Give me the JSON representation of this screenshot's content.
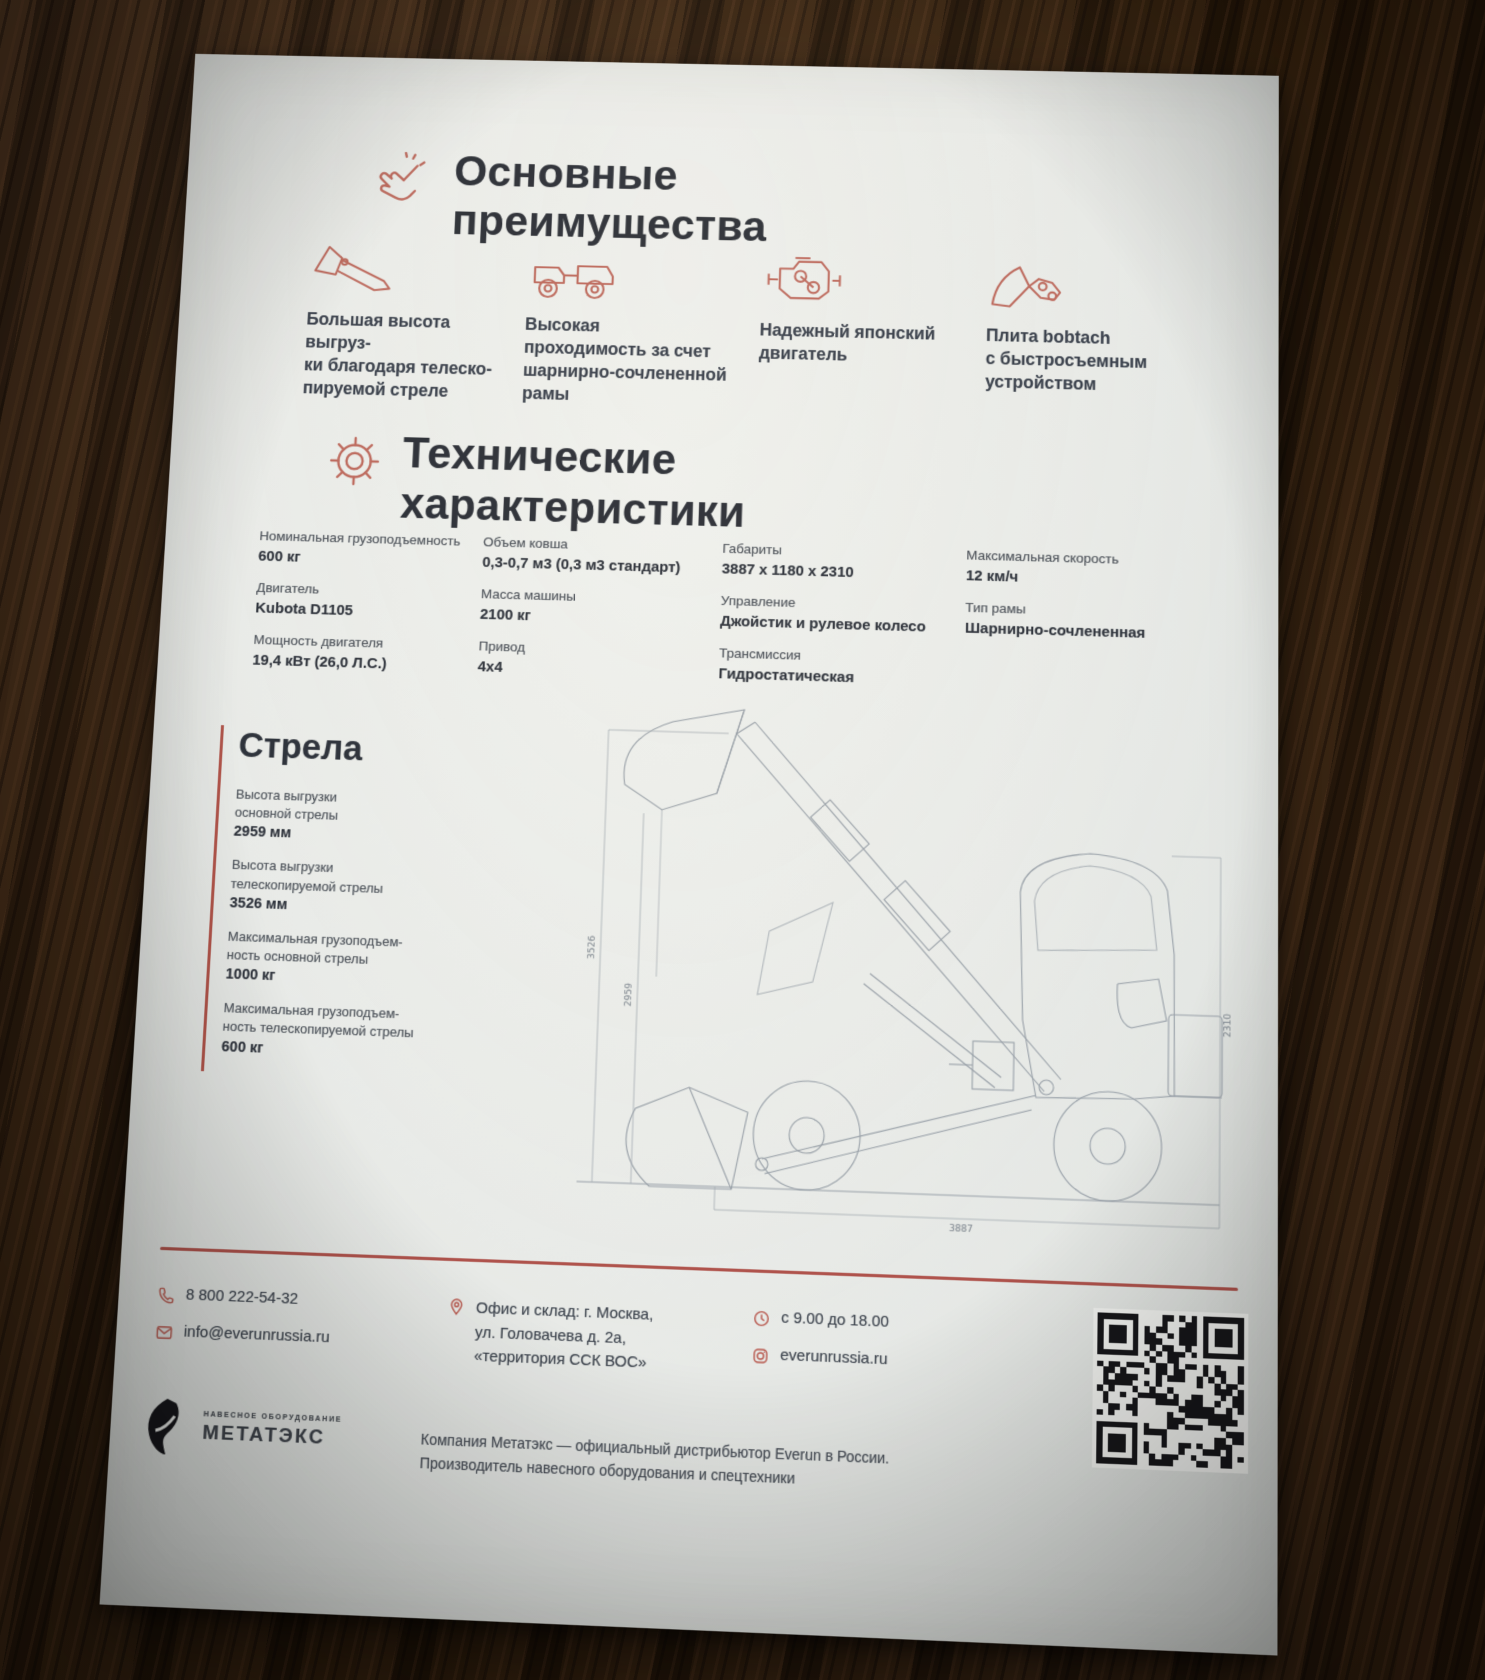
{
  "colors": {
    "accent_icon": "#bd6a5e",
    "accent_line": "#a8433b",
    "heading_ink": "#2b2f37",
    "body_ink": "#3a414d",
    "paper": "#e9ebe8"
  },
  "advantages_section": {
    "title_line1": "Основные",
    "title_line2": "преимущества",
    "items": [
      {
        "icon": "bucket-boom-icon",
        "lines": [
          "Большая высота выгруз-",
          "ки благодаря телеско-",
          "пируемой стреле"
        ]
      },
      {
        "icon": "articulated-loader-icon",
        "lines": [
          "Высокая",
          "проходимость за счет",
          "шарнирно-сочлененной",
          "рамы"
        ]
      },
      {
        "icon": "engine-icon",
        "lines": [
          "Надежный японский",
          "двигатель",
          "",
          ""
        ]
      },
      {
        "icon": "bobtach-plate-icon",
        "lines": [
          "Плита bobtach",
          "с быстросъемным",
          "устройством",
          ""
        ]
      }
    ]
  },
  "specs_section": {
    "title_line1": "Технические",
    "title_line2": "характеристики",
    "columns": [
      [
        {
          "label": "Номинальная грузоподъемность",
          "value": "600 кг"
        },
        {
          "label": "Двигатель",
          "value": "Kubota D1105"
        },
        {
          "label": "Мощность двигателя",
          "value": "19,4 кВт (26,0 Л.С.)"
        }
      ],
      [
        {
          "label": "Объем ковша",
          "value": "0,3-0,7 м3 (0,3 м3 стандарт)"
        },
        {
          "label": "Масса машины",
          "value": "2100 кг"
        },
        {
          "label": "Привод",
          "value": "4х4"
        }
      ],
      [
        {
          "label": "Габариты",
          "value": "3887 х 1180 х 2310"
        },
        {
          "label": "Управление",
          "value": "Джойстик и рулевое колесо"
        },
        {
          "label": "Трансмиссия",
          "value": "Гидростатическая"
        }
      ],
      [
        {
          "label": "Максимальная скорость",
          "value": "12 км/ч"
        },
        {
          "label": "Тип рамы",
          "value": "Шарнирно-сочлененная"
        }
      ]
    ]
  },
  "boom_section": {
    "title": "Стрела",
    "items": [
      {
        "label_lines": [
          "Высота выгрузки",
          "основной стрелы"
        ],
        "value": "2959 мм"
      },
      {
        "label_lines": [
          "Высота выгрузки",
          "телескопируемой стрелы"
        ],
        "value": "3526 мм"
      },
      {
        "label_lines": [
          "Максимальная грузоподъем-",
          "ность основной стрелы"
        ],
        "value": "1000 кг"
      },
      {
        "label_lines": [
          "Максимальная грузоподъем-",
          "ность телескопируемой стрелы"
        ],
        "value": "600 кг"
      }
    ]
  },
  "drawing": {
    "dim_left_outer": "3526",
    "dim_left_inner": "2959",
    "dim_bottom": "3887",
    "dim_right": "2310"
  },
  "footer": {
    "phone": "8 800 222-54-32",
    "email": "info@everunrussia.ru",
    "address_lines": [
      "Офис и склад: г. Москва,",
      "ул. Головачева д. 2а,",
      "«территория ССК ВОС»"
    ],
    "hours": "с 9.00 до 18.00",
    "website": "everunrussia.ru"
  },
  "brand": {
    "tagline": "НАВЕСНОЕ ОБОРУДОВАНИЕ",
    "name": "МЕТАТЭКС",
    "description_lines": [
      "Компания Метатэкс — официальный дистрибьютор Everun в России.",
      "Производитель навесного оборудования и спецтехники"
    ]
  }
}
